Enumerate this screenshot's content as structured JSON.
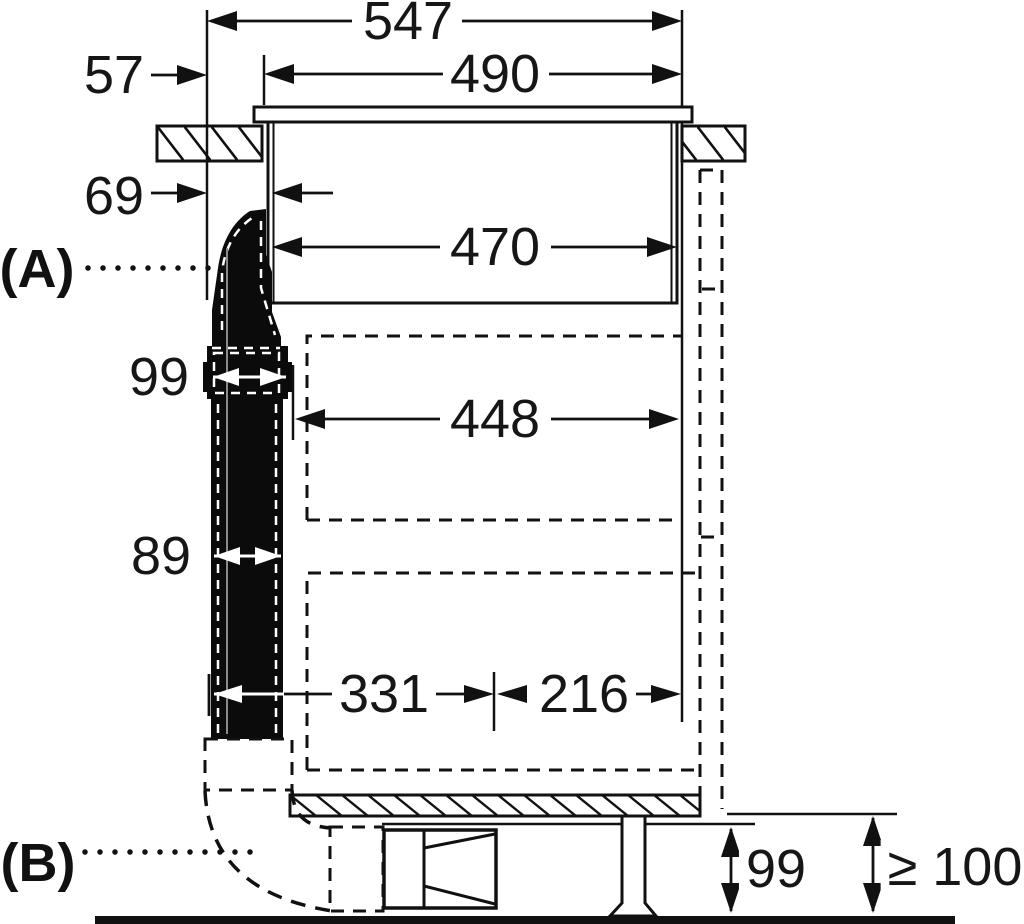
{
  "diagram": {
    "description": "Appliance installation side-view drawing with millimetre dimensions",
    "section_labels": {
      "a": "(A)",
      "b": "(B)"
    },
    "dimensions": {
      "total_width": "547",
      "cutout_width": "490",
      "left_offset": "57",
      "body_inset": "69",
      "body_width": "470",
      "inner_clearance": "448",
      "flange_width": "99",
      "duct_depth": "89",
      "duct_to_axis": "331",
      "axis_to_side": "216",
      "plinth_height": "99",
      "floor_clearance": "≥ 100"
    },
    "colors": {
      "line": "#111111",
      "duct_fill": "#0b0b0b",
      "background": "#ffffff"
    }
  }
}
